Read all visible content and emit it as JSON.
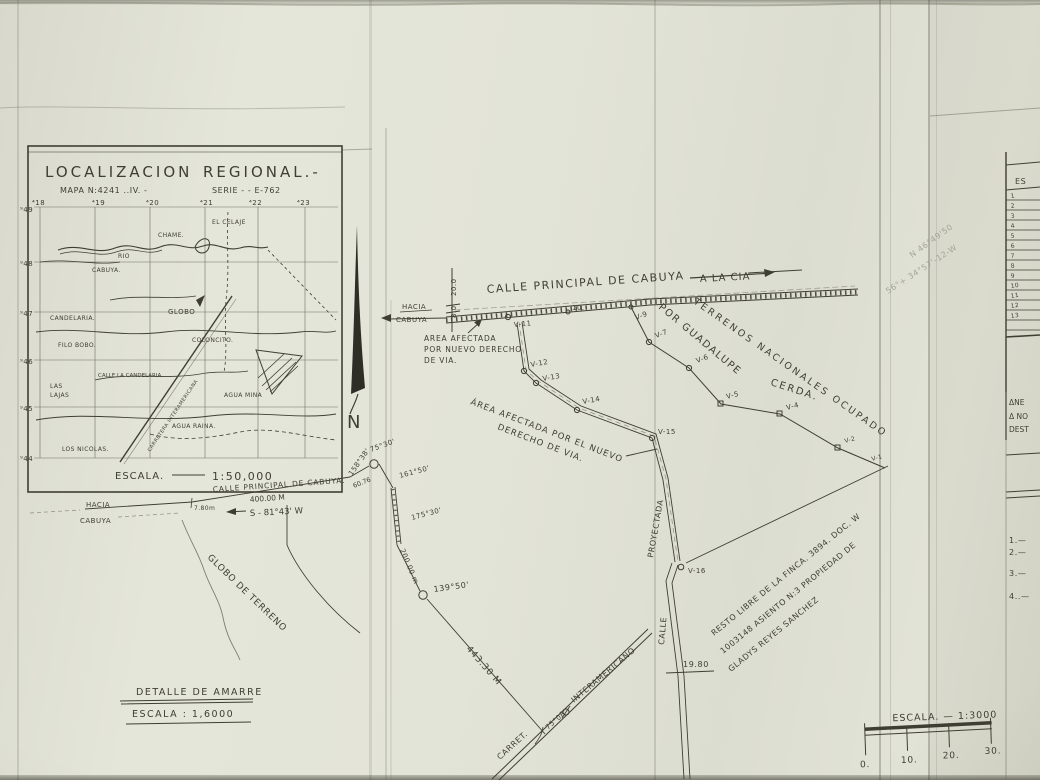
{
  "paper": {
    "ink": "#3f3e33",
    "ink_light": "#6b6a5b",
    "pencil": "#97968a",
    "bg": "#e3e4d8"
  },
  "inset": {
    "title": "LOCALIZACION",
    "title2": "REGIONAL.-",
    "map_no": "MAPA N:4241 ..IV. -",
    "serie": "SERIE - - E-762",
    "grid_top": [
      "⁴18",
      "⁴19",
      "⁴20",
      "⁴21",
      "⁴22",
      "⁴23"
    ],
    "grid_left": [
      "⁹49",
      "⁹48",
      "⁹47",
      "⁹46",
      "⁹45",
      "⁹44"
    ],
    "places": {
      "el_celaje": "EL CELAJE",
      "chame": "CHAME.",
      "rio": "RIO",
      "cabuya": "CABUYA.",
      "globo": "GLOBO",
      "candelaria": "CANDELARIA.",
      "filo_bobo": "FILO BOBO.",
      "coloncito": "COLONCITO.",
      "calle_candelaria": "CALLE LA CANDELARIA.",
      "las": "LAS",
      "lajas": "LAJAS",
      "agua_mina": "AGUA MINA",
      "agua_raina": "AGUA RAINA.",
      "los_nicolas": "LOS NICOLAS.",
      "carretera": "CARRETERA INTERAMERICANA"
    },
    "scale_word": "ESCALA.",
    "scale_value": "1:50,000"
  },
  "north": {
    "label": "N"
  },
  "road": {
    "label": "CALLE  PRINCIPAL  DE  CABUYA",
    "to_right": "A LA CIA",
    "to_left1": "HACIA",
    "to_left2": "CABUYA",
    "w1": "20.0",
    "w2": "8.0"
  },
  "stations": {
    "v11": "V-11",
    "v10": "10.",
    "v9": "V-9",
    "v7": "V-7",
    "v6": "V-6",
    "v5": "V-5",
    "v4": "V-4",
    "v2": "V-2",
    "v1": "V-1",
    "v12": "V-12",
    "v13": "V-13",
    "v14": "V-14",
    "v15": "V-15",
    "v16": "V-16"
  },
  "notes": {
    "afectada1a": "AREA AFECTADA",
    "afectada1b": "POR NUEVO DERECHO",
    "afectada1c": "DE VIA.",
    "afectada2a": "ÁREA  AFECTADA  POR  EL  NUEVO",
    "afectada2b": "DERECHO  DE  VIA.",
    "terrenos": "TERRENOS NACIONALES OCUPADO",
    "por_guadalupe": "POR GUADALUPE",
    "cerda": "CERDA.",
    "resto1": "RESTO LIBRE DE LA FINCA. 3894. DOC. W",
    "resto2": "1003148 ASIENTO N:3 PROPIEDAD DE",
    "resto3": "GLADYS  REYES  SANCHEZ"
  },
  "measures": {
    "a1": "158°38'",
    "a2": "75°30'",
    "a3": "161°50'",
    "a4": "175°30'",
    "a5": "139°50'",
    "a6": "75°08'",
    "d1": "60.76",
    "d2": "200.00 m",
    "d3": "443.30 M",
    "d4": "400.00 M",
    "bearing": "S - 81°43' W",
    "offset": "7.80m",
    "v16_dist": "19.80"
  },
  "proyectada": {
    "calle": "CALLE",
    "proyectada": "PROYECTADA"
  },
  "interamericana": {
    "carret": "CARRET.",
    "label": "INTERAMERICANO"
  },
  "globo_terreno": "GLOBO DE TERRENO",
  "bottom_left_road": "CALLE PRINCIPAL DE CABUYA.",
  "detalle": {
    "line1": "DETALLE DE AMARRE",
    "line2": "ESCALA : 1,6000"
  },
  "scalebar": {
    "label": "ESCALA. — 1:3000",
    "ticks": [
      "0.",
      "10.",
      "20.",
      "30."
    ]
  },
  "side_table": {
    "header": "ES",
    "rows": [
      "1",
      "2",
      "3",
      "4",
      "5",
      "6",
      "7",
      "8",
      "9",
      "10",
      "11",
      "12",
      "13"
    ],
    "notes": [
      "ΔNE",
      "Δ NO",
      "DEST"
    ],
    "list": [
      "1.—",
      "2.—",
      "3.—",
      "4..—"
    ]
  },
  "pencil": {
    "line1": "N 46°49'50",
    "line2": "56°+ 34°57'-12-W"
  }
}
